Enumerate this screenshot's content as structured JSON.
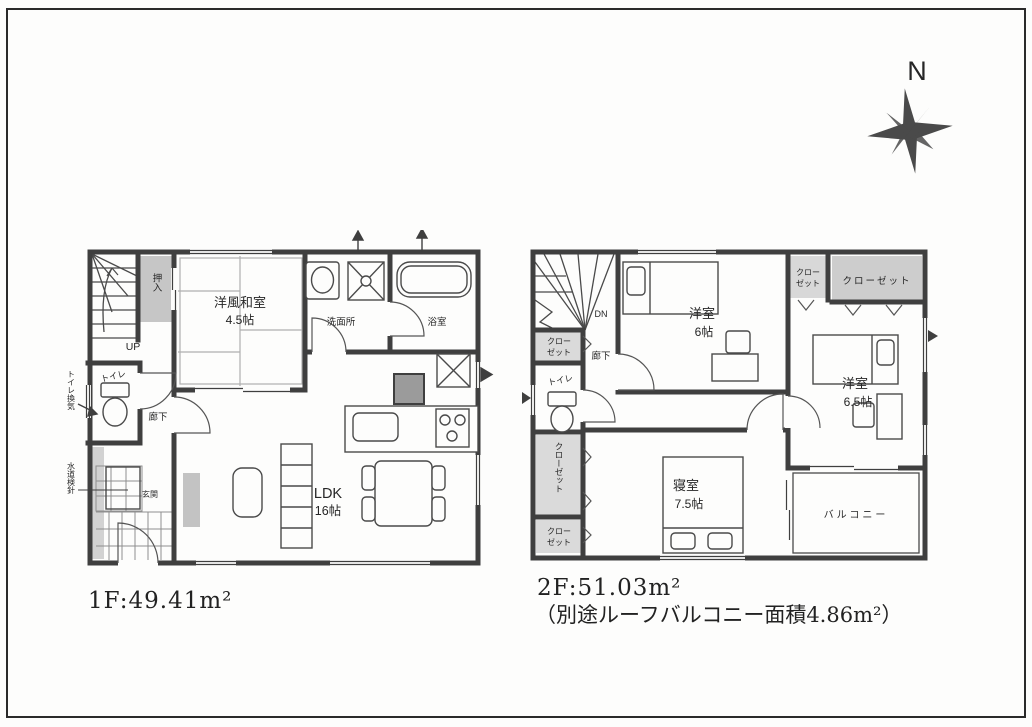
{
  "compass": {
    "north": "N"
  },
  "floor1": {
    "area": "1F:49.41m²",
    "labels": {
      "up": "UP",
      "oshiire": "押入",
      "washitsu_name": "洋風和室",
      "washitsu_size": "4.5帖",
      "senmenjo": "洗面所",
      "bath": "浴室",
      "toilet": "トイレ",
      "hallway": "廊下",
      "genkan": "玄関",
      "ldk_name": "LDK",
      "ldk_size": "16帖",
      "vent_note": "トイレ換気",
      "meter_note": "水道検針"
    }
  },
  "floor2": {
    "area": "2F:51.03m²",
    "note": "（別途ルーフバルコニー面積4.86m²）",
    "labels": {
      "dn": "DN",
      "hallway": "廊下",
      "toilet": "トイレ",
      "closet_line1": "クロー",
      "closet_line2": "ゼット",
      "closet_full": "クローゼット",
      "yoshitsu6_name": "洋室",
      "yoshitsu6_size": "6帖",
      "yoshitsu65_name": "洋室",
      "yoshitsu65_size": "6.5帖",
      "shinshitsu_name": "寝室",
      "shinshitsu_size": "7.5帖",
      "balcony": "バルコニー"
    }
  }
}
